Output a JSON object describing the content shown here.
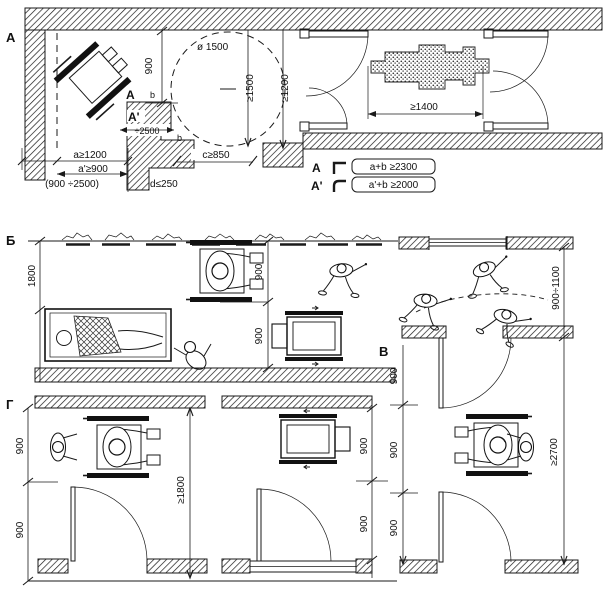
{
  "sections": {
    "a": "А",
    "b": "Б",
    "v": "В",
    "g": "Г"
  },
  "plan_a": {
    "corner_label": "А",
    "corner_label_prime": "А'",
    "dim_b900": "900",
    "letter_b_upper": "b",
    "letter_b_lower": "b",
    "dim_pier": "÷2500",
    "turning_circle": "ø 1500",
    "dim_ge1500": "≥1500",
    "dim_ge1200": "≥1200",
    "dim_c850": "c≥850",
    "dim_a1200": "a≥1200",
    "dim_a900": "a'≥900",
    "dim_range": "(900 ÷2500)",
    "dim_d250": "d≤250",
    "dim_ge1400": "≥1400"
  },
  "legend": {
    "row1_corner": "А",
    "row1_rule": "a+b ≥2300",
    "row2_corner": "А'",
    "row2_rule": "a'+b ≥2000"
  },
  "plan_b": {
    "dim_1800": "1800",
    "dim_900_upper": "900",
    "dim_900_lower": "900"
  },
  "plan_v": {
    "dim_900_1100": "900÷1100",
    "dim_900_1": "900",
    "dim_900_2": "900",
    "dim_900_3": "900",
    "dim_ge2700": "≥2700"
  },
  "plan_g": {
    "dim_900_1": "900",
    "dim_900_2": "900",
    "dim_ge1800": "≥1800",
    "dim_room2_900_1": "900",
    "dim_room2_900_2": "900"
  },
  "colors": {
    "ink": "#1a1a1a",
    "paper": "#ffffff"
  }
}
